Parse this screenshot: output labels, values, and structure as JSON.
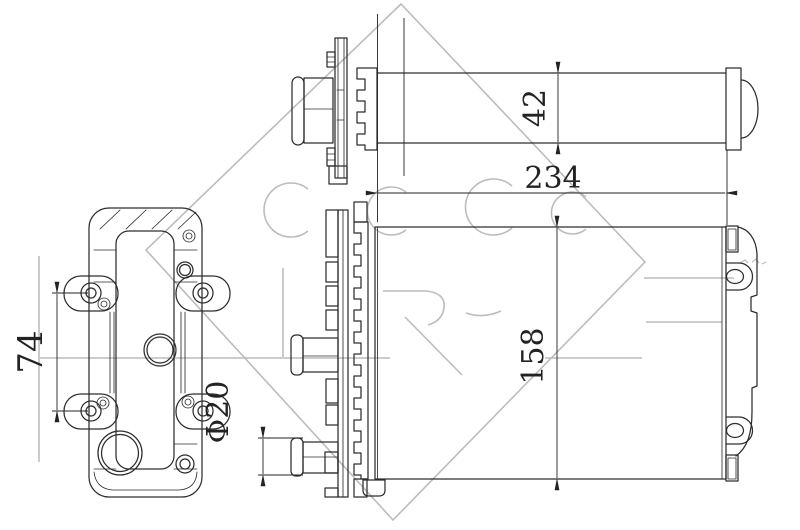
{
  "document": {
    "kind": "technical-drawing",
    "background": "#ffffff"
  },
  "colors": {
    "drawing_line": "#2d2d2d",
    "dimension_line": "#232323",
    "watermark": "#bcbcbc"
  },
  "dimensions": {
    "overall_length": "234",
    "overall_height": "158",
    "tank_depth": "42",
    "mount_hole_spacing": "74",
    "pipe_diameter": "Φ20"
  }
}
